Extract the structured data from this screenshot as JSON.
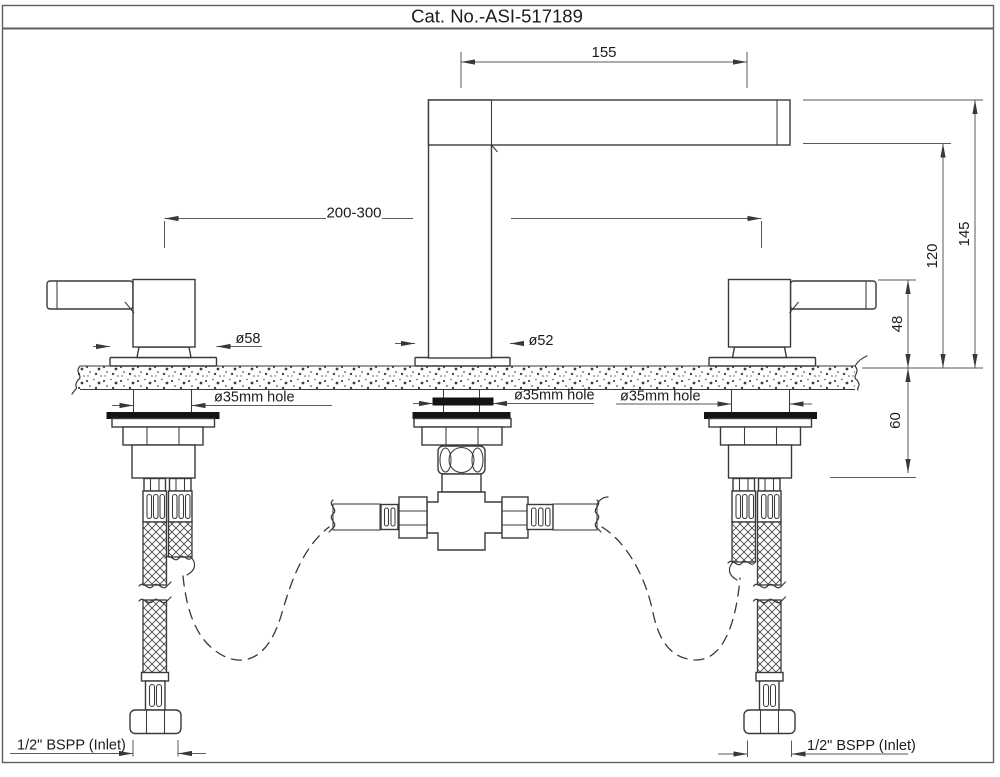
{
  "title": "Cat. No.-ASI-517189",
  "dimensions": {
    "spout_reach": "155",
    "inlet_centers": "200-300",
    "total_height": "145",
    "spout_underside_height": "120",
    "handle_height": "48",
    "max_deck_thickness": "60"
  },
  "labels": {
    "handle_base_diameter": "ø58",
    "spout_base_diameter": "ø52",
    "hole_left": "ø35mm hole",
    "hole_center": "ø35mm hole",
    "hole_right": "ø35mm hole",
    "inlet_left": "1/2\" BSPP (Inlet)",
    "inlet_right": "1/2\" BSPP (Inlet)"
  },
  "colors": {
    "line": "#3a3a3a",
    "dim": "#5a5a5a",
    "dim2": "#383838",
    "text": "#1c1c1c",
    "washer": "#141414",
    "border": "#5f5f5f",
    "paper": "#ffffff"
  }
}
